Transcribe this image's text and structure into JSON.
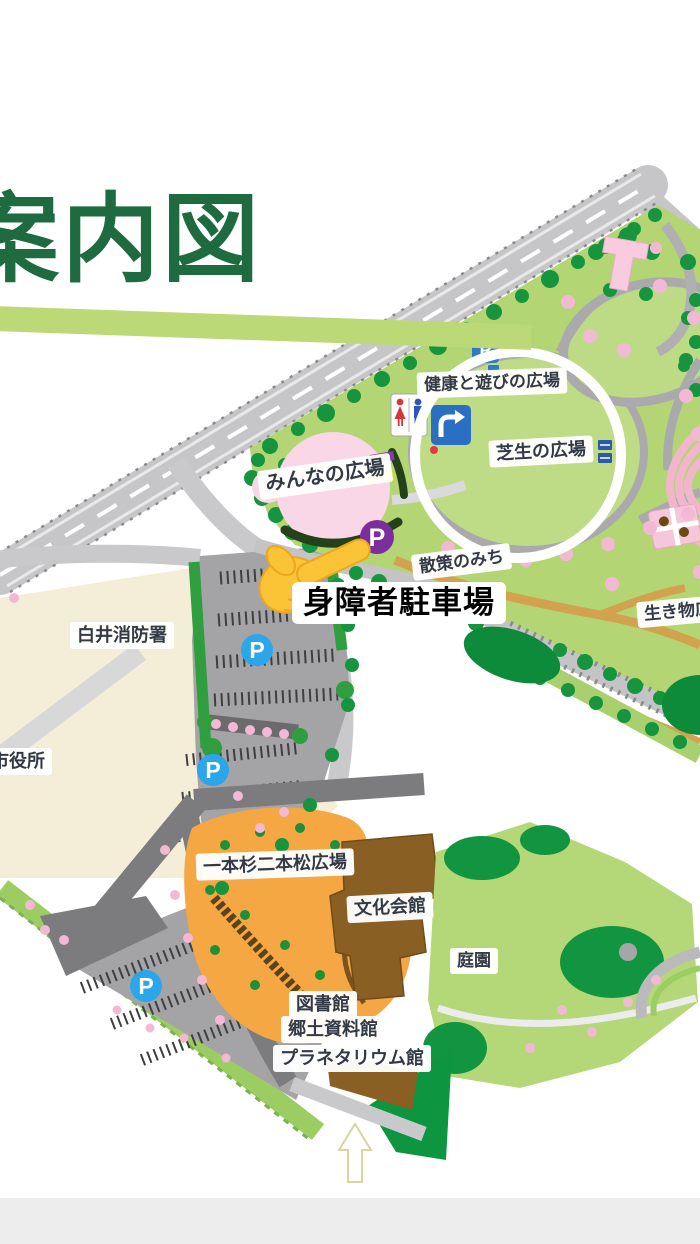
{
  "page": {
    "title": "案内図"
  },
  "map": {
    "labels": {
      "kenko": "健康と遊びの広場",
      "shibafu": "芝生の広場",
      "minna": "みんなの広場",
      "sansaku": "散策のみち",
      "ikimono": "生き物広場",
      "fire_station": "白井消防署",
      "city_hall": "市役所",
      "ippon_sugi": "一本杉二本松広場",
      "bunka_kaikan": "文化会館",
      "teien": "庭園",
      "library": "図書館",
      "kyodo_museum": "郷土資料館",
      "planetarium": "プラネタリウム館"
    },
    "callout": {
      "accessible_parking": "身障者駐車場"
    },
    "icons": {
      "parking_letter": "P"
    },
    "palette": {
      "title_green": "#1e6b3f",
      "band_green": "#bcd977",
      "park_green": "#b3d573",
      "tree_green": "#17953e",
      "deep_green": "#0d9540",
      "road_gray": "#c6c6c8",
      "dark_road_gray": "#7c7c7e",
      "parking_gray": "#a4a4a6",
      "beige": "#f4eed8",
      "plaza_orange": "#f4a743",
      "building_brown": "#8a5f23",
      "blossom_pink": "#f3b9d4",
      "parking_blue": "#2ba7e9",
      "accessible_purple": "#7b2f9c"
    }
  }
}
